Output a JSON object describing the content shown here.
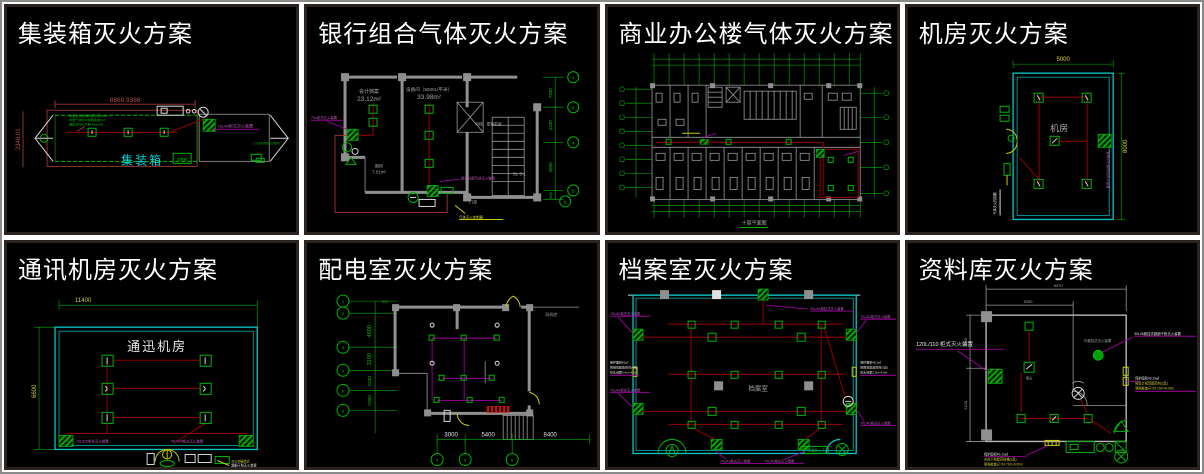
{
  "colors": {
    "panel_background": "#000000",
    "divider": "#ffffff",
    "panel_frame": "#2b2320",
    "title": "#ffffff",
    "cad_green": "#00b400",
    "cad_red": "#a33838",
    "cad_dark_red": "#8b0000",
    "cad_cyan": "#00c8c8",
    "cad_magenta": "#b400b4",
    "cad_yellow": "#c8c800",
    "cad_gray": "#909090"
  },
  "panels": [
    {
      "title": "集装箱灭火方案",
      "room_label": "集装箱",
      "dim_width": "8860.9386",
      "dim_height": "2348.01",
      "note_lines": [
        "报警时,铃声蜂鸣显示灯(1M)",
        "内置气体灭火控制系统/0.2",
        "储压式ABC干粉 4kg×4只"
      ],
      "device_label": "70L/W柜式灭火装置",
      "side_label": "L=18.0006×1.0000",
      "box_label": "控制柜"
    },
    {
      "title": "银行组合气体灭火方案",
      "room1_name": "会计档案",
      "room1_area": "23.12m²",
      "room2_name": "设备间（5000L/平米）",
      "room2_area": "33.98m²",
      "room3_name": "厕所",
      "room3_area": "7.01m²",
      "hall_label": "电梯、楼梯前室",
      "stair_label": "BL-5-1",
      "door_label": "门禁",
      "label_left": "70L柜式灭火装置",
      "label_mid": "组合分配气体灭火管网",
      "label_bottom": "气体灭火控制器",
      "dims_right": [
        "7300",
        "2400",
        "3600",
        "600"
      ],
      "bubbles_right": [
        "1",
        "2",
        "4",
        "5",
        "6"
      ]
    },
    {
      "title": "商业办公楼气体灭火方案",
      "caption": "十层平面图"
    },
    {
      "title": "机房灭火方案",
      "room_label": "机房",
      "dim_width": "5000",
      "dim_height": "8000",
      "device_label": "管网式七氟丙烷灭火装置",
      "panel_label": "气体灭火控制器"
    },
    {
      "title": "通讯机房灭火方案",
      "room_label": "通迅机房",
      "dim_width": "11400",
      "dim_height": "6600",
      "label_left": "70L/120柜式灭火装置",
      "label_right": "70L/120柜式灭火装置",
      "note_lines": [
        "30L/3t悬挂式",
        "超细干粉灭火装置"
      ]
    },
    {
      "title": "配电室灭火方案",
      "dim_top": "310",
      "dims_left": [
        "4600",
        "3100",
        "2200",
        "2000"
      ],
      "dims_bottom": [
        "3000",
        "5400",
        "8400"
      ],
      "room_label": "风机房",
      "bubbles_left": [
        "1",
        "2",
        "3",
        "4",
        "5",
        "6"
      ],
      "bubbles_bottom": [
        "4",
        "5",
        "6"
      ]
    },
    {
      "title": "档案室灭火方案",
      "room_label": "档案室",
      "label_top": "30L/A2悬挂式灭火装置",
      "label_left_top": "70L/A2柜式灭火装置",
      "label_left_bottom": "70L/A2柜式灭火装置",
      "label_right_top": "70L/A2柜式灭火装置",
      "label_right_bottom": "70L/A2柜式灭火装置",
      "label_bottom_left": "70L/A2柜式灭火装置",
      "label_bottom_right": "70L/A2柜式灭火装置",
      "note_left": [
        "保护面积62㎡",
        "按规范配置药剂(4具)",
        "喷头间距3.0m~4.0m"
      ],
      "note_right": [
        "保护面积46.2㎡",
        "按规范配置药剂(3具)",
        "喷头间距3.0m~4.0m"
      ],
      "corner_label": "乙级防火门"
    },
    {
      "title": "资料库灭火方案",
      "dim_top": "8470",
      "dim_mid": "5200",
      "dims_left": [
        "3000",
        "2100"
      ],
      "main_label": "120L/110 柜式灭火装置",
      "hang_label": "30L/3t悬挂式超细干粉灭火装置",
      "circle_label": "内悬挂式灭火装置",
      "nozzle_label": "喷头",
      "note_right": [
        "保护面积40.13㎡",
        "按设计规范配药剂(3具)",
        "喷嘴覆盖尺寸4.72m×6.00m"
      ],
      "note_bottom": [
        "保护面积40.13㎡",
        "对应干粉配药规格(3具)",
        "喷嘴覆盖尺寸4.72m×6.00m"
      ]
    }
  ]
}
